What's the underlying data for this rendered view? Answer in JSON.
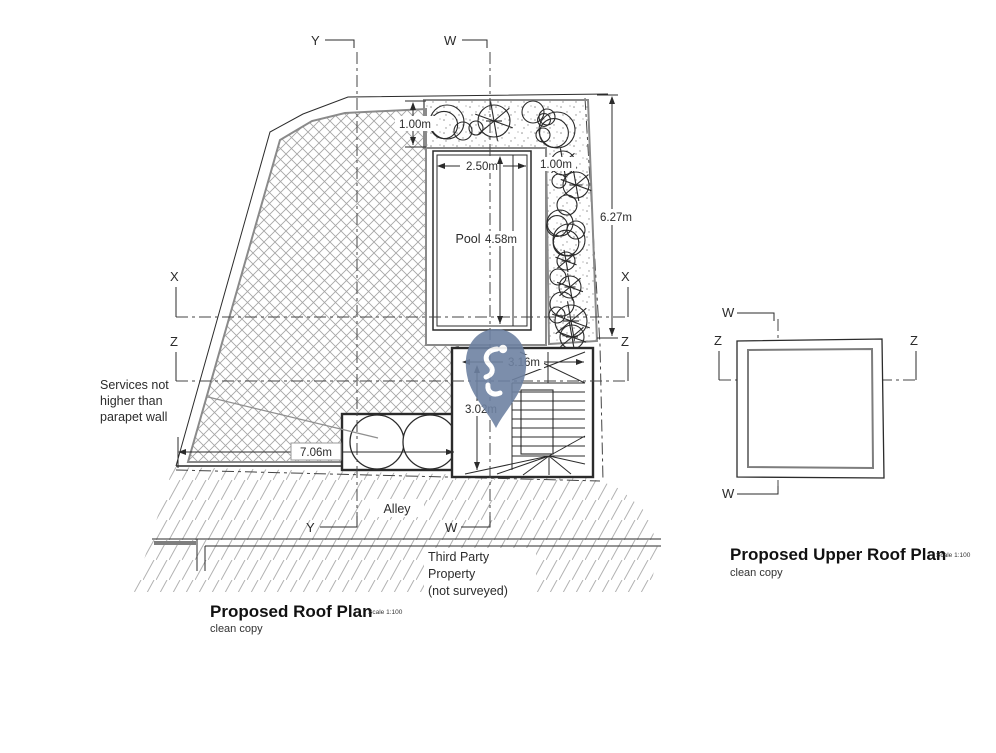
{
  "main_plan": {
    "title": "Proposed Roof Plan",
    "scale_note": "Scale 1:100",
    "subtitle": "clean copy",
    "labels": {
      "pool": "Pool",
      "alley": "Alley",
      "third_party": [
        "Third Party",
        "Property",
        "(not surveyed)"
      ],
      "services_note": [
        "Services not",
        "higher than",
        "parapet wall"
      ]
    },
    "dimensions": {
      "planter_depth_top": "1.00m",
      "pool_width": "2.50m",
      "planter_depth_right": "1.00m",
      "pool_length": "4.58m",
      "garden_right_length": "6.27m",
      "stair_room_width": "3.16m",
      "stair_room_depth": "3.02m",
      "terrace_width": "7.06m"
    },
    "sections": {
      "x": "X",
      "y": "Y",
      "w": "W",
      "z": "Z"
    }
  },
  "upper_plan": {
    "title": "Proposed Upper Roof Plan",
    "scale_note": "Scale 1:100",
    "subtitle": "clean copy",
    "sections": {
      "w": "W",
      "z": "Z"
    }
  },
  "watermark": {
    "pin_color": "#6e82a2"
  }
}
